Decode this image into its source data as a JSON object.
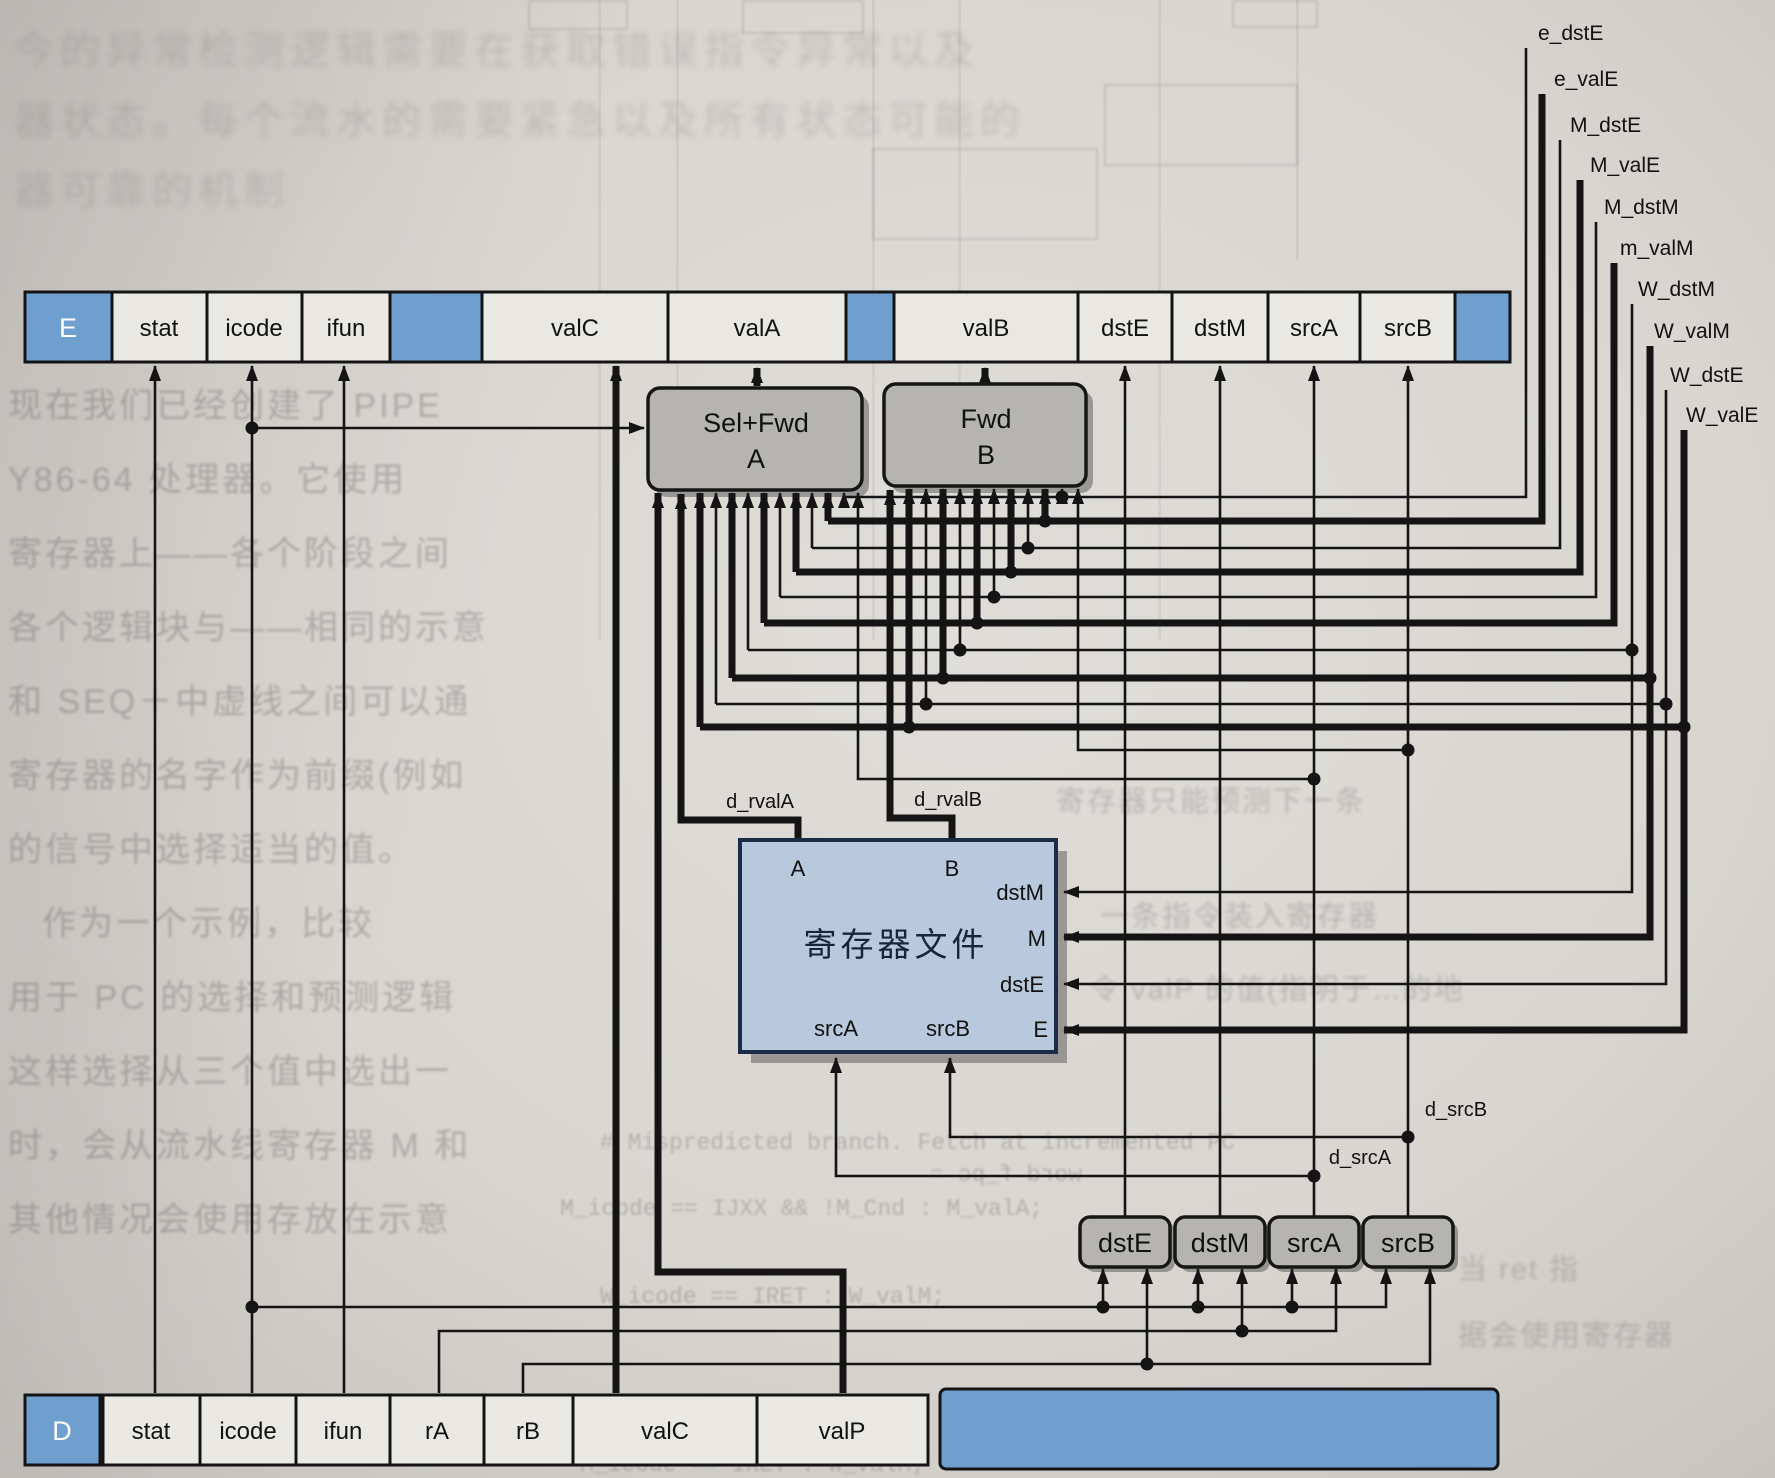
{
  "e_register": {
    "tag": "E",
    "fields": [
      "stat",
      "icode",
      "ifun",
      "valC",
      "valA",
      "valB",
      "dstE",
      "dstM",
      "srcA",
      "srcB"
    ]
  },
  "d_register": {
    "tag": "D",
    "fields": [
      "stat",
      "icode",
      "ifun",
      "rA",
      "rB",
      "valC",
      "valP"
    ]
  },
  "blocks": {
    "sel_fwd_a_line1": "Sel+Fwd",
    "sel_fwd_a_line2": "A",
    "fwd_b_line1": "Fwd",
    "fwd_b_line2": "B"
  },
  "register_file": {
    "title": "寄存器文件",
    "port_a": "A",
    "port_b": "B",
    "port_dstm": "dstM",
    "port_m": "M",
    "port_dste": "dstE",
    "port_e": "E",
    "port_srca": "srcA",
    "port_srcb": "srcB"
  },
  "decode_boxes": {
    "dste": "dstE",
    "dstm": "dstM",
    "srca": "srcA",
    "srcb": "srcB"
  },
  "signals": {
    "forwarding": [
      "e_dstE",
      "e_valE",
      "M_dstE",
      "M_valE",
      "M_dstM",
      "m_valM",
      "W_dstM",
      "W_valM",
      "W_dstE",
      "W_valE"
    ],
    "d_rvala": "d_rvalA",
    "d_rvalb": "d_rvalB",
    "d_srca": "d_srcA",
    "d_srcb": "d_srcB"
  },
  "colors": {
    "paper": "#d9d6d1",
    "accent_blue": "#6f9fcf",
    "block_gray": "#b6b4b0",
    "rf_fill": "#b9c9dd",
    "rf_border": "#1c2b46",
    "line": "#141414"
  },
  "bleed_text": [
    "今的异常检测逻辑需要在获取错误指令异常以及",
    "器状态。每个流水的需要紧急以及所有状态可能的",
    "器可靠的机制",
    "现在我们已经创建了 PIPE",
    "Y86-64 处理器。它使用",
    "寄存器上——各个阶段之间",
    "各个逻辑块与——相同的示意",
    "和 SEQ＋中虚线之间可以通",
    "寄存器的名字作为前缀(例如",
    "的信号中选择适当的值。",
    "作为一个示例，比较",
    "用于 PC 的选择和预测逻辑",
    "这样选择从三个值中选出一",
    "时，会从流水线寄存器 M 和",
    "其他情况会使用存放在示意",
    "寄存器只能预测下一条",
    "一条指令装入寄存器",
    "令 valP 的值(指明于…的地",
    "当 ret 指",
    "据会使用寄存器",
    "# Mispredicted branch.  Fetch at incremented PC",
    "M_icode == IJXX && !M_Cnd : M_valA;",
    "word f_pc =",
    "W_icode == IRET : W_valM;",
    "M_icode == IRET : W_valM;"
  ]
}
